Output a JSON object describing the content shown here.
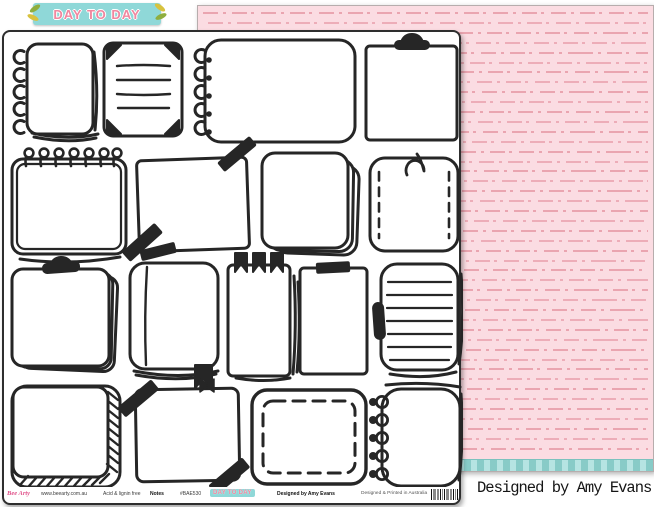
{
  "header": {
    "logo_text": "DAY TO DAY"
  },
  "credit": {
    "text": "Designed by Amy Evans"
  },
  "front_sheet": {
    "description": "white scrapbook paper printed with hand-drawn doodle note frames",
    "footer": {
      "brand": "Bee Arty",
      "website": "www.beearty.com.au",
      "quality": "Acid & lignin free",
      "title": "Notes",
      "sku": "#BAE530",
      "mini_logo": "DAY TO DAY",
      "designer": "Designed by Amy Evans",
      "origin": "Designed & Printed in Australia"
    },
    "frames": [
      "left-ring notebook",
      "photo-corner lined note",
      "wide ring notebook",
      "clipboard",
      "top-spiral notepad",
      "washi-taped note",
      "stacked sticky notes",
      "stitched note with hook",
      "clip pad",
      "journal with bookmark ribbon",
      "pennant-flag note",
      "taped tall note",
      "lined pad with side clip",
      "rope-edge note",
      "washi note with ribbon",
      "dashed-border note",
      "ring-bound notebook"
    ]
  },
  "back_sheet": {
    "pattern": "rows of dash-dot lines",
    "colors": {
      "background": "#fbdce2",
      "dash": "#eaa5b0",
      "stripe": "#8fd6d2"
    }
  },
  "colors": {
    "logo_teal": "#8fd8d8",
    "logo_pink": "#f0879f",
    "ink": "#262626"
  }
}
